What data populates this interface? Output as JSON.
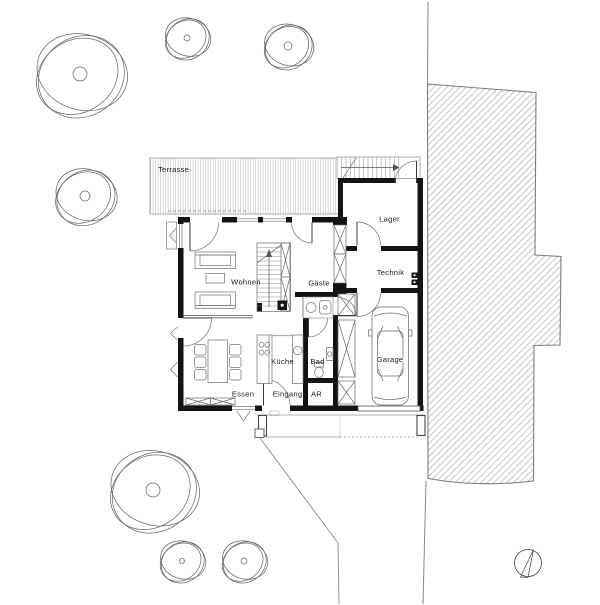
{
  "plan": {
    "rooms": {
      "terrasse": "Terrasse",
      "wohnen": "Wohnen",
      "gaeste": "Gäste",
      "lager": "Lager",
      "technik": "Technik",
      "kueche": "Küche",
      "bad": "Bad",
      "essen": "Essen",
      "eingang": "Eingang",
      "ar": "AR",
      "garage": "Garage"
    }
  },
  "site": {
    "trees": [
      {
        "cx": 80,
        "cy": 74,
        "r": 46,
        "trunk": 7
      },
      {
        "cx": 187,
        "cy": 38,
        "r": 23,
        "trunk": 3
      },
      {
        "cx": 288,
        "cy": 46,
        "r": 25,
        "trunk": 4
      },
      {
        "cx": 85,
        "cy": 196,
        "r": 31,
        "trunk": 5
      },
      {
        "cx": 153,
        "cy": 490,
        "r": 45,
        "trunk": 7
      },
      {
        "cx": 182,
        "cy": 561,
        "r": 23,
        "trunk": 2.5
      },
      {
        "cx": 244,
        "cy": 561,
        "r": 23,
        "trunk": 3
      }
    ],
    "north_arrow": {
      "cx": 528,
      "cy": 563,
      "r": 13.5
    }
  },
  "colors": {
    "wall": "#141414",
    "thin_line": "#666666",
    "site_line": "#8a8a8a",
    "terrace_hatch": "#c9c9c9",
    "drive_hatch": "#b5b5b5"
  }
}
